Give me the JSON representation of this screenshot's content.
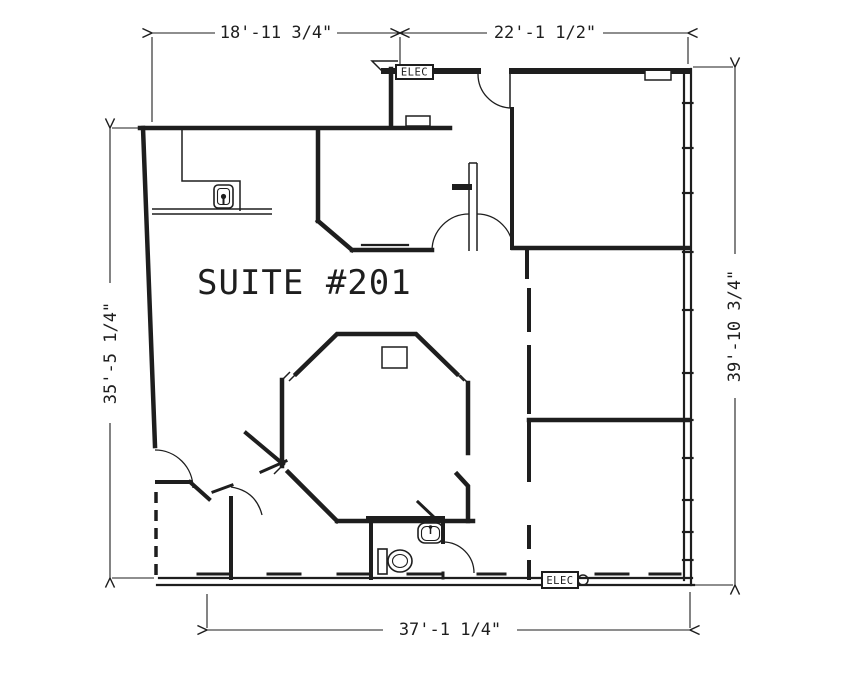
{
  "drawing": {
    "title": "SUITE #201",
    "dimensions": {
      "top_left": "18'-11 3/4\"",
      "top_right": "22'-1 1/2\"",
      "left": "35'-5 1/4\"",
      "right": "39'-10 3/4\"",
      "bottom": "37'-1 1/4\""
    },
    "labels": {
      "elec_top": "ELEC",
      "elec_bottom": "ELEC"
    },
    "colors": {
      "ink": "#1e1e1e",
      "paper": "#ffffff"
    },
    "fixtures": [
      "toilet-icon",
      "sink-icon",
      "outlet-icon",
      "ceiling-fixture-icon",
      "counter",
      "electrical-panel"
    ]
  }
}
